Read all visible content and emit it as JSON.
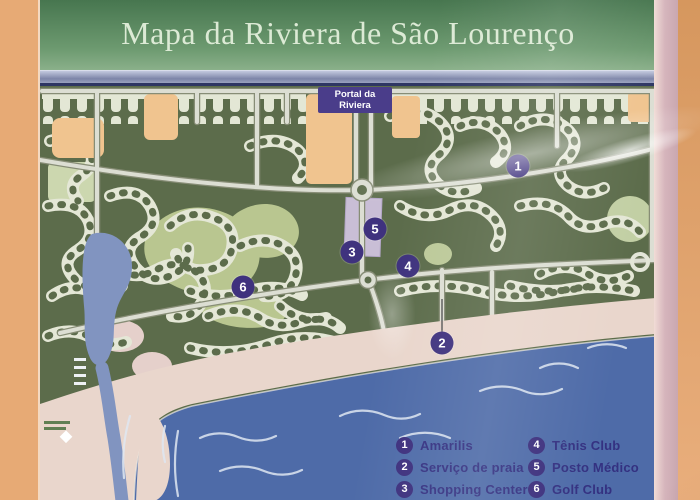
{
  "sign": {
    "title": "Mapa da Riviera de São Lourenço"
  },
  "map": {
    "portal_label_line1": "Portal da",
    "portal_label_line2": "Riviera",
    "markers": [
      {
        "number": "1",
        "x": 518,
        "y": 166
      },
      {
        "number": "2",
        "x": 442,
        "y": 343
      },
      {
        "number": "3",
        "x": 352,
        "y": 252
      },
      {
        "number": "4",
        "x": 408,
        "y": 266
      },
      {
        "number": "5",
        "x": 375,
        "y": 229
      },
      {
        "number": "6",
        "x": 243,
        "y": 287
      }
    ],
    "legend": {
      "items": [
        {
          "number": "1",
          "label": "Amarilis"
        },
        {
          "number": "2",
          "label": "Serviço de praia"
        },
        {
          "number": "3",
          "label": "Shopping Center"
        },
        {
          "number": "4",
          "label": "Tênis Club"
        },
        {
          "number": "5",
          "label": "Posto Médico"
        },
        {
          "number": "6",
          "label": "Golf Club"
        }
      ]
    }
  },
  "colors": {
    "wall_orange": "#e7aa75",
    "banner_green": "#5d8a62",
    "title_text": "#dcead5",
    "map_green": "#5c6c4a",
    "street_cream": "#e4e7d5",
    "lot_orange": "#f2c48d",
    "golf_green": "#b9c68e",
    "road_gray": "#dcded3",
    "river_blue": "#8094c2",
    "beach_sand": "#ead6cb",
    "sea_blue": "#4d6bab",
    "marker_purple": "#3f327e",
    "legend_text": "#343181",
    "portal_purple": "#4a3d8a",
    "frame_pink": "#d6b5bc"
  }
}
